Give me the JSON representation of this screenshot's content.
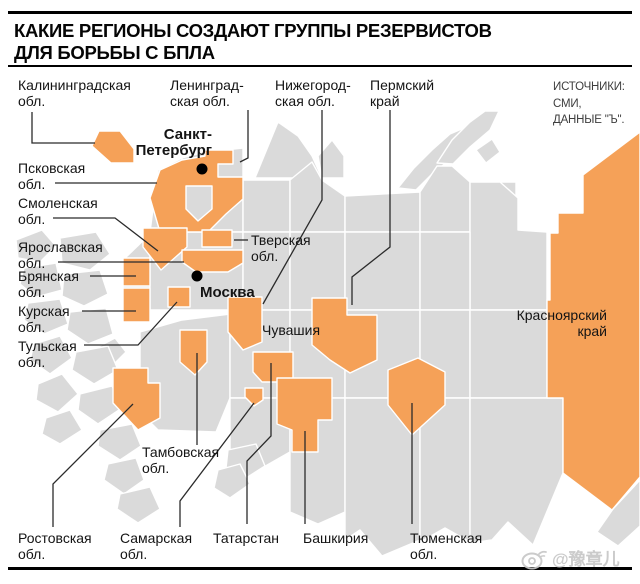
{
  "header": {
    "title_line1": "КАКИЕ РЕГИОНЫ СОЗДАЮТ ГРУППЫ РЕЗЕРВИСТОВ",
    "title_line2": "ДЛЯ БОРЬБЫ С БПЛА"
  },
  "sources": {
    "line1": "ИСТОЧНИКИ:",
    "line2": "СМИ,",
    "line3": "ДАННЫЕ \"Ъ\"."
  },
  "watermark": {
    "text": "@豫章儿",
    "icon": "weibo-eye-icon"
  },
  "colors": {
    "highlight": "#F5A158",
    "base": "#DADADA",
    "seam": "#FFFFFF",
    "leader": "#2B2B2B",
    "label": "#141414",
    "dot": "#000000"
  },
  "map": {
    "highlighted_region_count": 21,
    "labels": [
      {
        "id": "kaliningrad",
        "lines": [
          "Калининградская",
          "обл."
        ],
        "x": 18,
        "y": 90,
        "leader": "32,112 32,143 95,143"
      },
      {
        "id": "leningrad",
        "lines": [
          "Ленинград-",
          "ская обл."
        ],
        "x": 170,
        "y": 90,
        "leader": "248,110 248,158 240,162"
      },
      {
        "id": "nizhegorod",
        "lines": [
          "Нижегород-",
          "ская обл."
        ],
        "x": 275,
        "y": 90,
        "leader": "322,110 322,200 263,304"
      },
      {
        "id": "perm",
        "lines": [
          "Пермский",
          "край"
        ],
        "x": 370,
        "y": 90,
        "leader": "390,110 390,247 352,277 352,305"
      },
      {
        "id": "spb",
        "lines": [
          "Санкт-",
          "Петербург"
        ],
        "x": 212,
        "y": 139,
        "anchor": "end",
        "bold": true,
        "dot": [
          202,
          169
        ]
      },
      {
        "id": "pskov",
        "lines": [
          "Псковская",
          "обл."
        ],
        "x": 18,
        "y": 173,
        "leader": "55,183 157,183"
      },
      {
        "id": "smolensk",
        "lines": [
          "Смоленская",
          "обл."
        ],
        "x": 18,
        "y": 208,
        "leader": "53,218 115,218 158,251"
      },
      {
        "id": "yaroslavl",
        "lines": [
          "Ярославская",
          "обл."
        ],
        "x": 18,
        "y": 252,
        "leader": "58,262 184,262"
      },
      {
        "id": "bryansk",
        "lines": [
          "Брянская",
          "обл."
        ],
        "x": 18,
        "y": 281,
        "leader": "90,276 136,276"
      },
      {
        "id": "kursk",
        "lines": [
          "Курская",
          "обл."
        ],
        "x": 18,
        "y": 316,
        "leader": "82,311 136,311"
      },
      {
        "id": "tula",
        "lines": [
          "Тульская",
          "обл."
        ],
        "x": 18,
        "y": 351,
        "leader": "84,345 138,345 177,302"
      },
      {
        "id": "moscow",
        "lines": [
          "Москва"
        ],
        "x": 200,
        "y": 297,
        "bold": true,
        "dot": [
          197,
          276
        ]
      },
      {
        "id": "tver",
        "lines": [
          "Тверская",
          "обл."
        ],
        "x": 251,
        "y": 245,
        "leader": "234,240 248,240"
      },
      {
        "id": "chuvashia",
        "lines": [
          "Чувашия"
        ],
        "x": 262,
        "y": 335
      },
      {
        "id": "krasnoyarsk",
        "lines": [
          "Красноярский",
          "край"
        ],
        "x": 607,
        "y": 320,
        "anchor": "end"
      },
      {
        "id": "tambov",
        "lines": [
          "Тамбовская",
          "обл."
        ],
        "x": 142,
        "y": 457,
        "leader": "197,445 197,353"
      },
      {
        "id": "rostov",
        "lines": [
          "Ростовская",
          "обл."
        ],
        "x": 18,
        "y": 543,
        "leader": "53,527 53,484 133,404"
      },
      {
        "id": "samara",
        "lines": [
          "Самарская",
          "обл."
        ],
        "x": 120,
        "y": 543,
        "leader": "180,527 180,501 254,403"
      },
      {
        "id": "tatarstan",
        "lines": [
          "Татарстан"
        ],
        "x": 213,
        "y": 543,
        "leader": "247,524 247,461 271,436 271,363"
      },
      {
        "id": "bashkiria",
        "lines": [
          "Башкирия"
        ],
        "x": 303,
        "y": 543,
        "leader": "305,524 305,431"
      },
      {
        "id": "tyumen",
        "lines": [
          "Тюменская",
          "обл."
        ],
        "x": 410,
        "y": 543,
        "leader": "412,524 412,403"
      }
    ],
    "highlight_polygons": [
      {
        "name": "kaliningrad-region",
        "points": "99,131 120,131 134,149 134,163 111,163 92,146"
      },
      {
        "name": "pskov-spb-region",
        "points": "160,170 182,160 205,156 205,150 233,150 233,164 218,164 218,177 243,177 243,199 226,214 208,232 160,232 150,198"
      },
      {
        "name": "smolensk-region",
        "points": "143,228 187,228 187,247 161,270 143,247"
      },
      {
        "name": "tver-region",
        "points": "202,230 232,230 232,247 202,247"
      },
      {
        "name": "yaroslavl-region",
        "points": "182,250 243,250 243,263 228,272 196,272 182,262"
      },
      {
        "name": "bryansk-region",
        "points": "123,258 150,258 150,286 123,286"
      },
      {
        "name": "kursk-region",
        "points": "123,288 150,288 150,322 123,322"
      },
      {
        "name": "tula-region",
        "points": "168,287 190,287 190,307 168,307"
      },
      {
        "name": "nizhegorod-region",
        "points": "228,297 262,297 262,342 243,350 228,332"
      },
      {
        "name": "chuvashia-tatarstan-region",
        "points": "253,352 293,352 293,382 262,382 253,372"
      },
      {
        "name": "samara-region",
        "points": "245,388 263,388 263,400 254,406 245,397"
      },
      {
        "name": "perm-region",
        "points": "312,298 347,298 347,315 377,315 377,360 350,373 330,360 312,345"
      },
      {
        "name": "tambov-region",
        "points": "180,330 207,330 207,362 195,375 180,362"
      },
      {
        "name": "rostov-region",
        "points": "113,368 148,368 148,383 160,383 160,418 138,430 113,403"
      },
      {
        "name": "bashkiria-region",
        "points": "277,378 332,378 332,420 318,420 318,452 292,452 292,430 277,424"
      },
      {
        "name": "tyumen-region",
        "points": "388,370 418,358 445,372 445,405 412,435 388,405"
      },
      {
        "name": "krasnoyarsk-region",
        "points": "640,132 640,477 612,510 563,473 563,398 547,398 547,300 550,300 550,233 558,233 558,213 583,213 583,175"
      }
    ],
    "overlay_polygons": [
      {
        "name": "spb-inner-gray",
        "points": "186,186 212,186 212,209 198,221 186,209"
      }
    ],
    "base_polygons": [
      "255,178 278,122 298,136 312,156 322,178",
      "322,178 318,156 332,140 344,156 344,178",
      "398,188 414,168 432,150 450,134 464,128 470,140 452,158 432,174 416,190",
      "437,163 452,140 470,122 485,111 499,111 490,130 470,147 453,164",
      "476,150 492,139 500,152 486,163",
      "475,182 516,182 516,214 494,226 475,208",
      "150,232 158,170 182,158 182,232",
      "182,232 182,158 205,152 243,148 243,232",
      "243,232 243,180 290,180 290,232",
      "290,232 290,180 312,162 322,180 345,196 345,232",
      "345,232 345,196 420,192 420,232",
      "420,232 420,192 437,166 452,166 470,182 470,232",
      "470,310 470,182 500,182 518,198 518,230 547,232 547,310",
      "123,260 150,234 150,312 123,322",
      "150,310 150,232 243,232 243,310",
      "243,310 243,232 290,232 290,310",
      "290,310 290,232 345,232 345,310",
      "345,310 345,232 420,232 420,310",
      "420,310 420,232 470,232 470,310",
      "140,394 140,332 182,320 230,314 230,398 216,432 158,430 140,412",
      "230,398 230,310 290,310 290,398",
      "290,398 290,310 345,310 345,398",
      "345,398 345,310 420,310 420,398",
      "420,398 420,310 470,310 470,398",
      "470,398 470,310 547,310 547,398",
      "230,455 230,398 290,398 290,452 262,468",
      "290,512 290,398 345,398 345,512 318,524",
      "345,540 345,398 420,398 420,540 382,556 360,530",
      "420,542 420,398 470,398 470,542 445,528",
      "470,543 470,398 563,398 563,473 533,545 508,522 492,540",
      "613,509 640,480 640,526 618,546 597,532",
      "16,240 42,230 56,246 40,262 18,258",
      "60,238 96,232 110,254 90,270 62,263",
      "24,268 56,263 62,290 36,297 20,284",
      "64,274 100,270 108,294 84,306 62,296",
      "28,303 60,299 68,324 44,334 24,320",
      "70,312 106,308 113,334 88,344 67,330",
      "96,348 115,338 126,352 112,366 94,362",
      "34,344 60,336 72,358 50,374 30,360",
      "76,352 108,346 118,370 94,384 72,370",
      "38,384 62,374 78,394 58,412 36,400",
      "80,394 112,386 122,408 98,424 78,410",
      "46,418 70,410 82,430 60,444 42,434",
      "100,430 132,424 141,446 120,460 98,446",
      "108,464 136,458 144,480 124,494 104,480",
      "120,494 150,487 160,509 138,523 117,509",
      "228,450 256,444 265,466 243,480 226,468",
      "218,470 240,464 250,484 230,498 214,488"
    ]
  }
}
